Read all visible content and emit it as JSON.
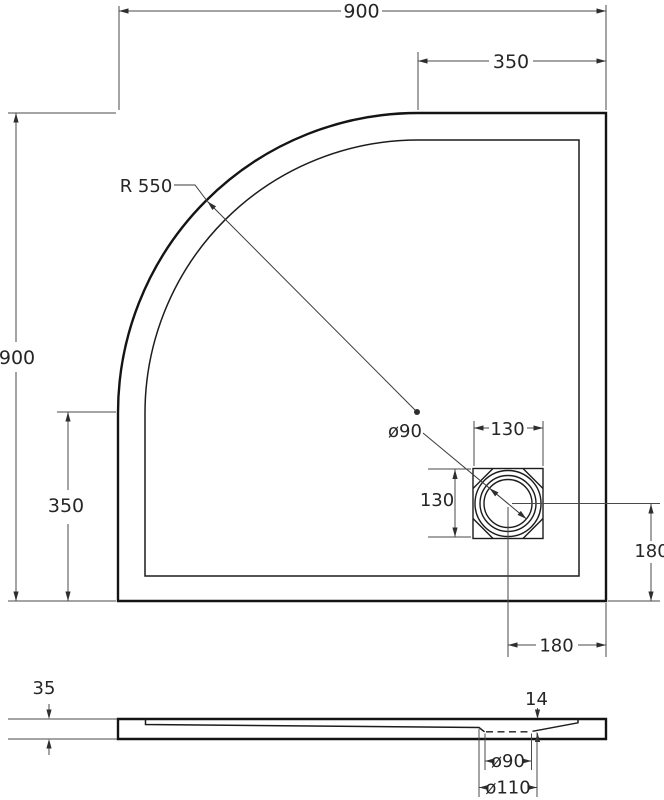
{
  "top_view": {
    "width": "900",
    "height": "900",
    "top_offset": "350",
    "side_offset": "350",
    "corner_radius": "R 550",
    "drain_diameter": "ø90",
    "drain_box_width": "130",
    "drain_box_height": "130",
    "drain_offset_right": "180",
    "drain_offset_bottom": "180"
  },
  "section_view": {
    "tray_height": "35",
    "drain_recess_depth": "14",
    "drain_hole_diameter": "ø90",
    "drain_opening_diameter": "ø110"
  },
  "colors": {
    "outline": "#141414",
    "dimension": "#4a4a4a",
    "background": "#ffffff"
  }
}
